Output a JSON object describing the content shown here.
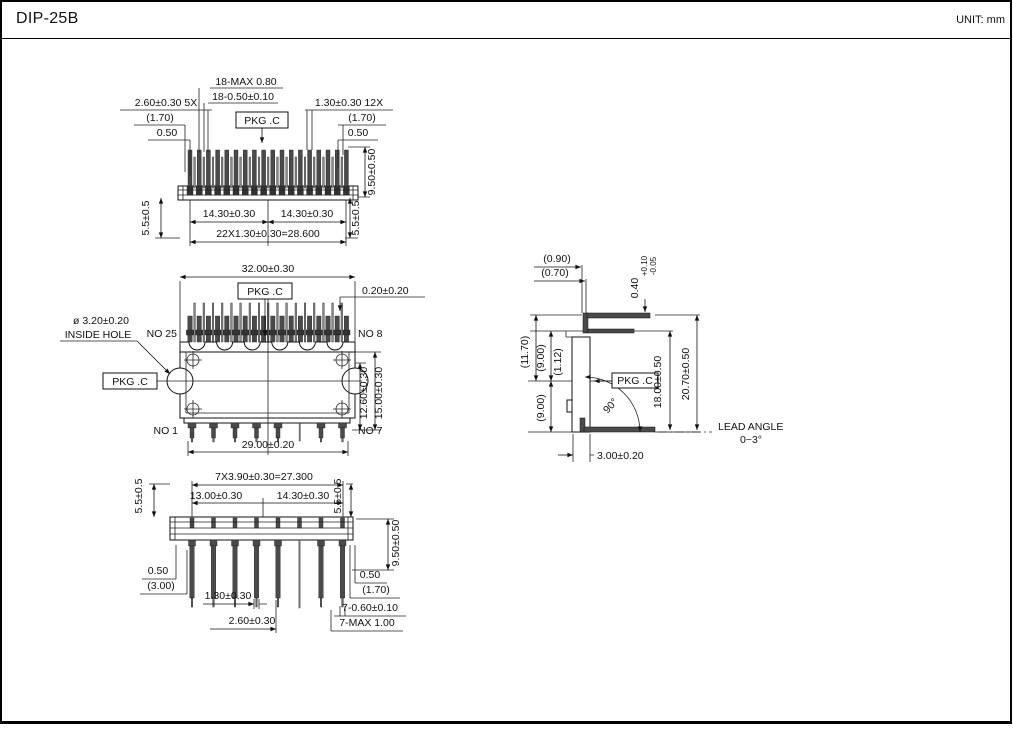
{
  "colors": {
    "ink": "#111111",
    "background": "#ffffff"
  },
  "header": {
    "title": "DIP-25B",
    "unit": "UNIT: mm"
  },
  "top_view": {
    "dim_18_max": "18-MAX 0.80",
    "dim_18_tol": "18-0.50±0.10",
    "dim_260_5x": "2.60±0.30 5X",
    "ref_170_l": "(1.70)",
    "dim_050_l": "0.50",
    "pkg": "PKG .C",
    "dim_130_12x": "1.30±0.30 12X",
    "ref_170_r": "(1.70)",
    "dim_050_r": "0.50",
    "dim_950": "9.50±0.50",
    "dim_55_l": "5.5±0.5",
    "dim_1430_l": "14.30±0.30",
    "dim_1430_r": "14.30±0.30",
    "dim_22x": "22X1.30±0.30=28.600",
    "dim_55_r": "5.5±0.5"
  },
  "front_view": {
    "dim_3200": "32.00±0.30",
    "pkg_top": "PKG .C",
    "dim_020": "0.20±0.20",
    "hole_dia": "ø 3.20±0.20",
    "hole_label": "INSIDE HOLE",
    "pin_no25": "NO 25",
    "pin_no8": "NO 8",
    "pin_no1": "NO 1",
    "pin_no7": "NO 7",
    "pkg_left": "PKG .C",
    "dim_2900": "29.00±0.20",
    "dim_1260": "12.60±0.30",
    "dim_1500": "15.00±0.30"
  },
  "side_view": {
    "ref_090": "(0.90)",
    "ref_070": "(0.70)",
    "dim_040": "0.40",
    "dim_040_plus": "+0.10",
    "dim_040_minus": "-0.05",
    "ref_1170": "(11.70)",
    "ref_900_u": "(9.00)",
    "ref_112": "(1.12)",
    "ref_900_l": "(9.00)",
    "pkg": "PKG .C",
    "dim_1800": "18.00±0.50",
    "dim_2070": "20.70±0.50",
    "angle_90": "90°",
    "lead_angle_1": "LEAD ANGLE",
    "lead_angle_2": "0~3°",
    "dim_300": "3.00±0.20"
  },
  "bottom_view": {
    "dim_55_l": "5.5±0.5",
    "dim_7x390": "7X3.90±0.30=27.300",
    "dim_1300": "13.00±0.30",
    "dim_1430": "14.30±0.30",
    "dim_55_r": "5.5±0.5",
    "dim_950": "9.50±0.50",
    "dim_050_l": "0.50",
    "ref_300": "(3.00)",
    "dim_130": "1.30±0.30",
    "dim_260": "2.60±0.30",
    "dim_050_r": "0.50",
    "ref_170": "(1.70)",
    "dim_7_060": "7-0.60±0.10",
    "dim_7_max": "7-MAX 1.00"
  }
}
